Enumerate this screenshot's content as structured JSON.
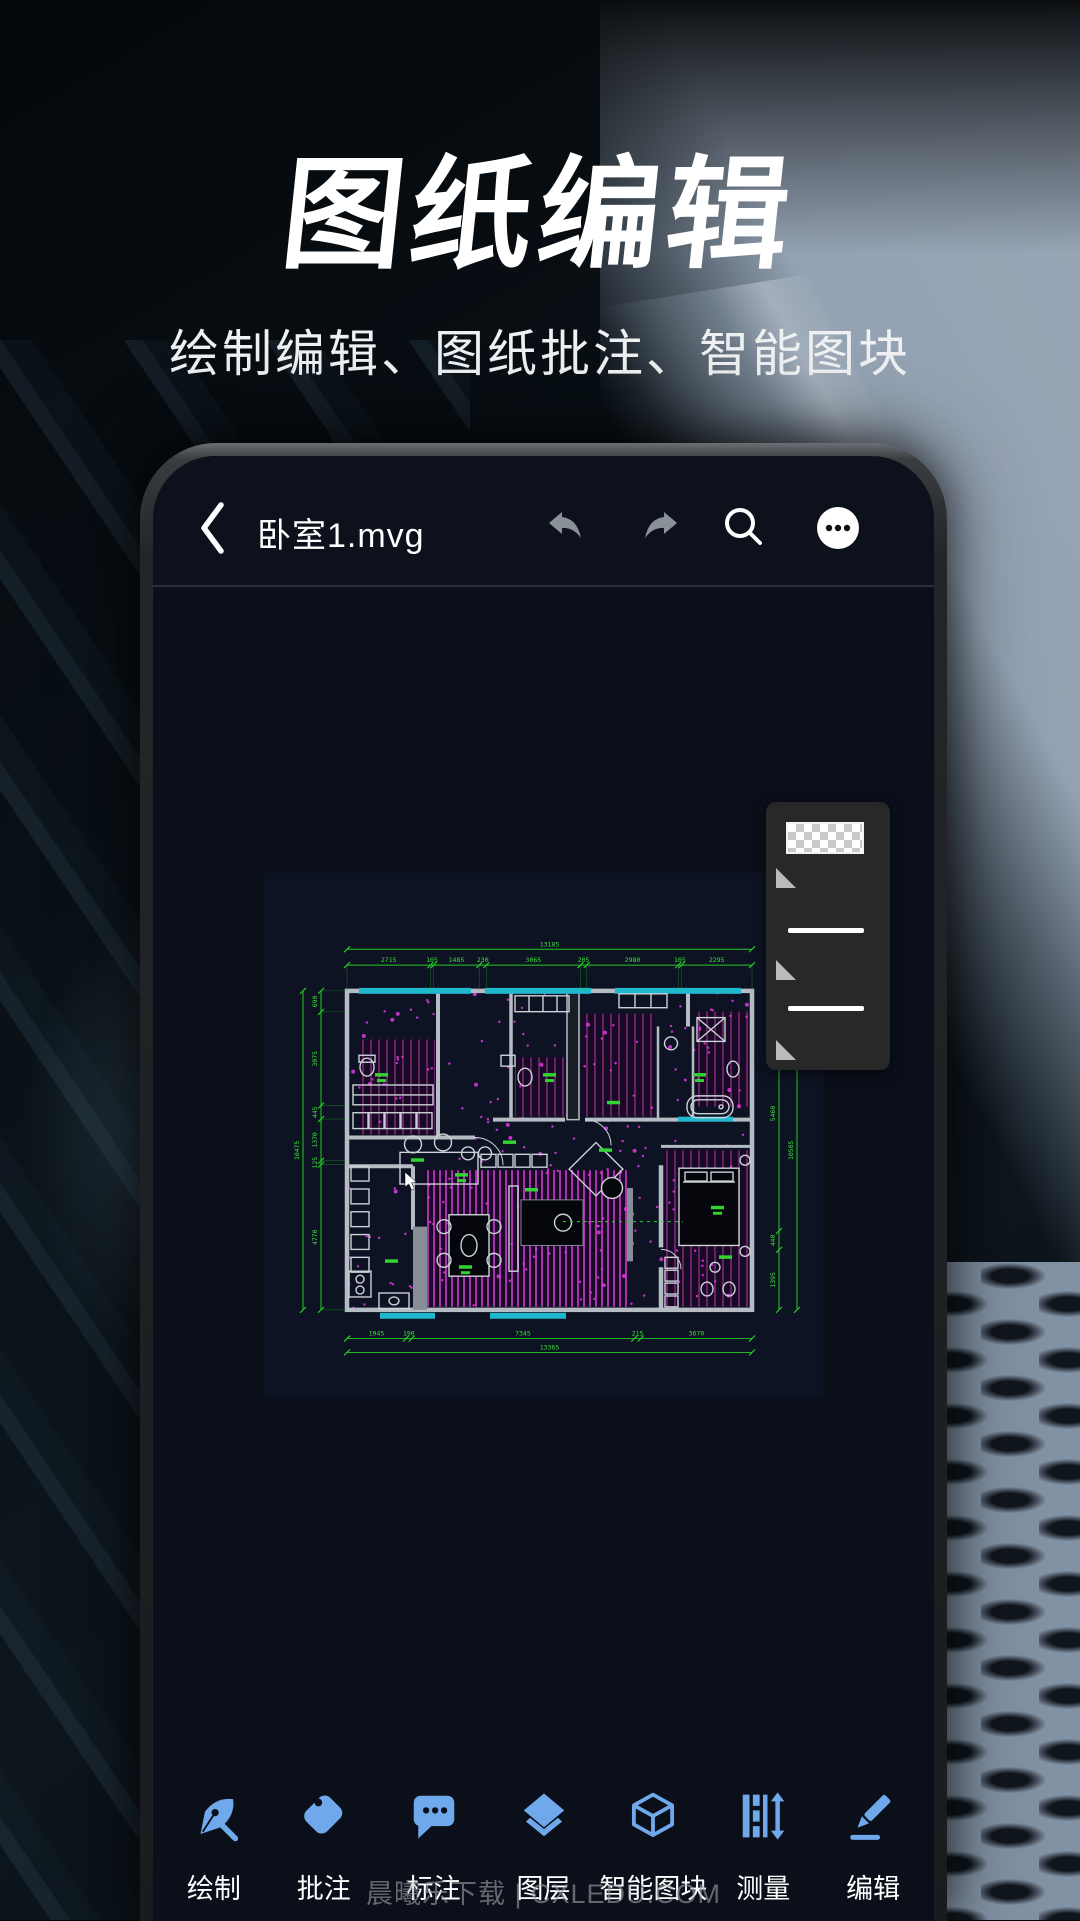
{
  "hero": {
    "title": "图纸编辑",
    "subtitle": "绘制编辑、图纸批注、智能图块"
  },
  "phone": {
    "topbar": {
      "title": "卧室1.mvg"
    },
    "canvas": {
      "dims": {
        "top": {
          "total": "13185",
          "segments": [
            "2715",
            "105",
            "1485",
            "230",
            "3065",
            "205",
            "2980",
            "105",
            "2295"
          ]
        },
        "bottom": {
          "total": "13365",
          "segments": [
            "1945",
            "190",
            "7345",
            "215",
            "3670"
          ]
        },
        "left": {
          "total": "10475",
          "segments": [
            "690",
            "3075",
            "445",
            "1370",
            "125",
            "4770"
          ]
        },
        "right": {
          "total": "10585",
          "segments": [
            "120",
            "5460",
            "440",
            "1395"
          ]
        }
      }
    },
    "panel": {
      "items": [
        "pattern-swatch",
        "marker",
        "stroke-line",
        "marker",
        "stroke-line",
        "marker"
      ]
    },
    "toolbar": [
      {
        "label": "绘制"
      },
      {
        "label": "批注"
      },
      {
        "label": "标注"
      },
      {
        "label": "图层"
      },
      {
        "label": "智能图块"
      },
      {
        "label": "测量"
      },
      {
        "label": "编辑"
      }
    ]
  },
  "watermark": "晨曦乐下载 | CXLEDU.COM",
  "colors": {
    "toolbar_icon": "#6FA9EC",
    "dim_green": "#27CB27",
    "hatch_magenta": "#B136B5",
    "window_teal": "#1FB8CF",
    "panel_bg": "#282828",
    "screen_bg": "#0A0F1A"
  }
}
